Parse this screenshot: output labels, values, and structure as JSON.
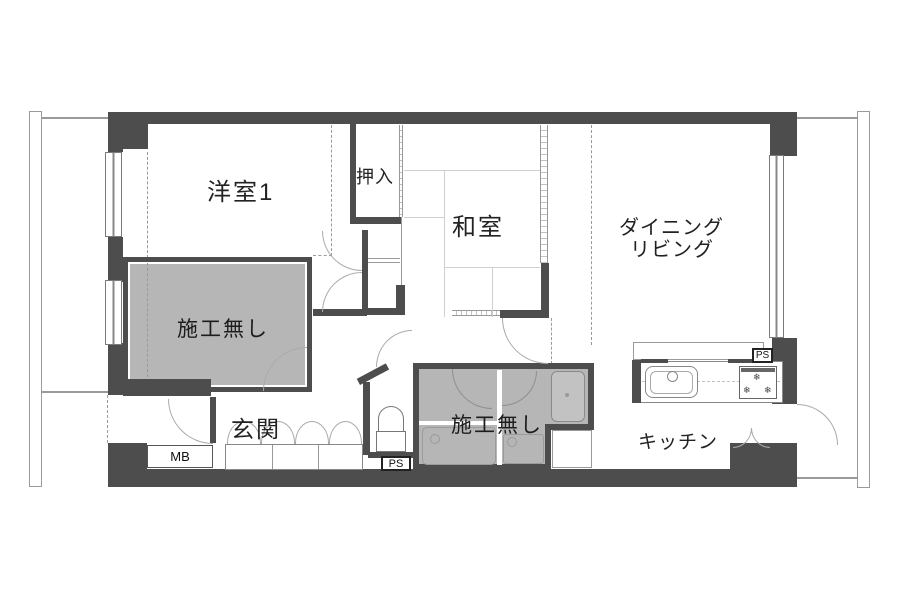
{
  "rooms": {
    "western_room_1": {
      "label": "洋室1"
    },
    "closet": {
      "label": "押入"
    },
    "japanese_room": {
      "label": "和室"
    },
    "dining_living": {
      "line1": "ダイニング",
      "line2": "リビング"
    },
    "no_construction_left": {
      "label": "施工無し"
    },
    "no_construction_center": {
      "label": "施工無し"
    },
    "entrance": {
      "label": "玄関"
    },
    "kitchen": {
      "label": "キッチン"
    }
  },
  "service_boxes": {
    "meter_box": {
      "label": "MB"
    },
    "pipe_space_bottom": {
      "label": "PS"
    },
    "pipe_space_right": {
      "label": "PS"
    }
  },
  "icons": {
    "snowflake": "❄"
  },
  "colors": {
    "wall": "#4d4d4d",
    "no_construction_fill": "#b6b6b6",
    "background": "#ffffff",
    "thin_line": "#9a9a9a"
  }
}
